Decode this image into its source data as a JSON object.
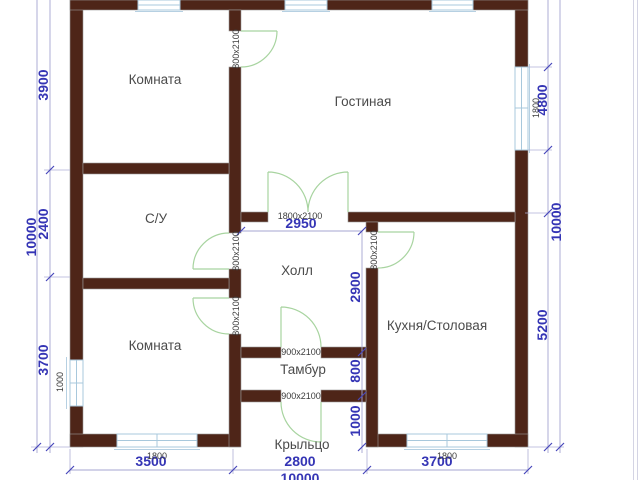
{
  "plan": {
    "rooms": {
      "room_tl": "Комната",
      "living": "Гостиная",
      "bathroom": "С/У",
      "hall": "Холл",
      "room_bl": "Комната",
      "kitchen": "Кухня/Столовая",
      "tambour": "Тамбур",
      "porch": "Крыльцо"
    },
    "dims": {
      "left_total": "10000",
      "left_segs": [
        "3900",
        "2400",
        "3700"
      ],
      "right_total": "10000",
      "right_segs": [
        "4800",
        "5200"
      ],
      "bottom_total": "10000",
      "bottom_segs": [
        "3500",
        "2800",
        "3700"
      ],
      "hall_width": "2950",
      "hall_height": "2900",
      "tambour_depth": "800",
      "porch_depth": "1000"
    },
    "doors": {
      "room_tl_door": "800x2100",
      "bathroom_door": "800x2100",
      "room_bl_door": "800x2100",
      "kitchen_door": "800x2100",
      "hall_double_door": "1800x2100",
      "tambour_door": "900x2100",
      "porch_door": "900x2100"
    },
    "windows": {
      "right_window": "1800",
      "left_window": "1000",
      "bottom_left_window": "1800",
      "bottom_right_window": "1800"
    },
    "colors": {
      "wall": "#4e2518",
      "dimension_text": "#3535b5",
      "dimension_line": "#a6a6d2",
      "door_swing": "#a8d4a0",
      "window": "#a8c8dc",
      "room_text": "#4b4b4b",
      "opening_text": "#3c3c3c",
      "background": "#ffffff"
    }
  }
}
